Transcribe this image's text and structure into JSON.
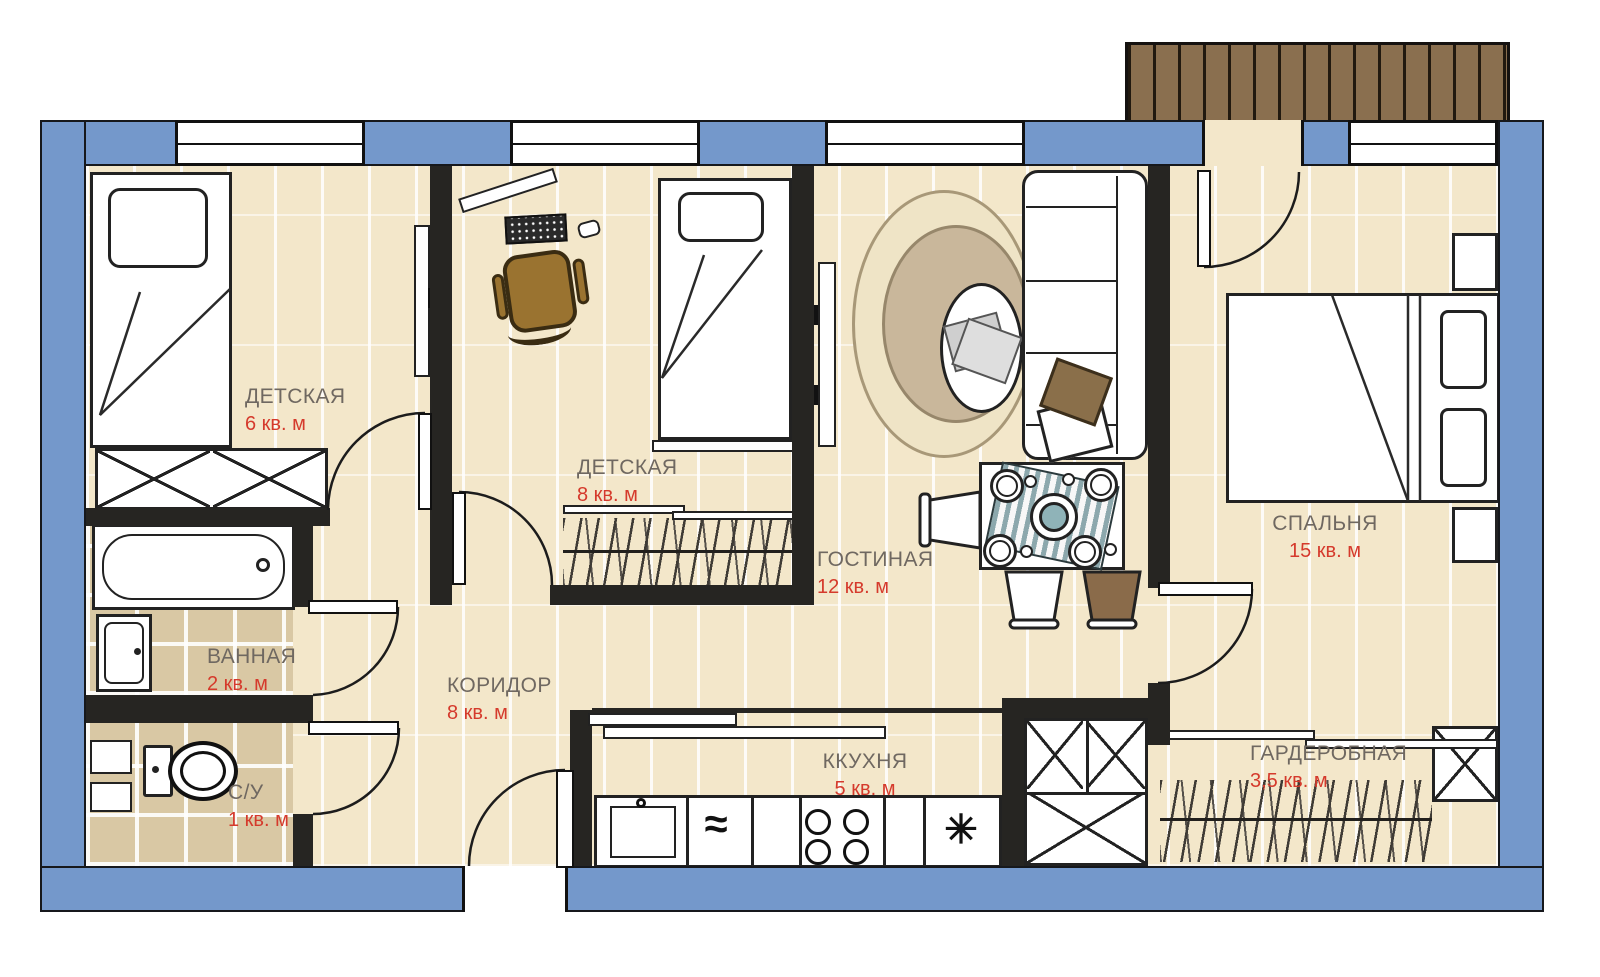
{
  "plan_type": "apartment-floor-plan",
  "rooms": [
    {
      "key": "children-room-1",
      "name": "ДЕТСКАЯ",
      "area": "6 кв. м"
    },
    {
      "key": "children-room-2",
      "name": "ДЕТСКАЯ",
      "area": "8 кв. м"
    },
    {
      "key": "living-room",
      "name": "ГОСТИНАЯ",
      "area": "12 кв. м"
    },
    {
      "key": "bedroom",
      "name": "СПАЛЬНЯ",
      "area": "15 кв. м"
    },
    {
      "key": "bathroom",
      "name": "ВАННАЯ",
      "area": "2 кв. м"
    },
    {
      "key": "wc",
      "name": "С/У",
      "area": "1 кв. м"
    },
    {
      "key": "corridor",
      "name": "КОРИДОР",
      "area": "8 кв. м"
    },
    {
      "key": "kitchen",
      "name": "ККУХНЯ",
      "area": "5 кв. м"
    },
    {
      "key": "wardrobe-room",
      "name": "ГАРДЕРОБНАЯ",
      "area": "3,5 кв. м"
    }
  ],
  "kitchen_glyphs": {
    "dishwasher": "≈",
    "fridge": "✳"
  },
  "colors": {
    "outer_wall_blue": "#7498cb",
    "interior_wall": "#262522",
    "floor_beige": "#f3e7ca",
    "tile_tan": "#d9c8a4",
    "balcony_brown": "#8a6f4f",
    "area_red": "#d53a2c",
    "room_label_gray": "#6f6861",
    "chair_brown": "#9a7330",
    "runner_teal": "#8ca8ad"
  }
}
